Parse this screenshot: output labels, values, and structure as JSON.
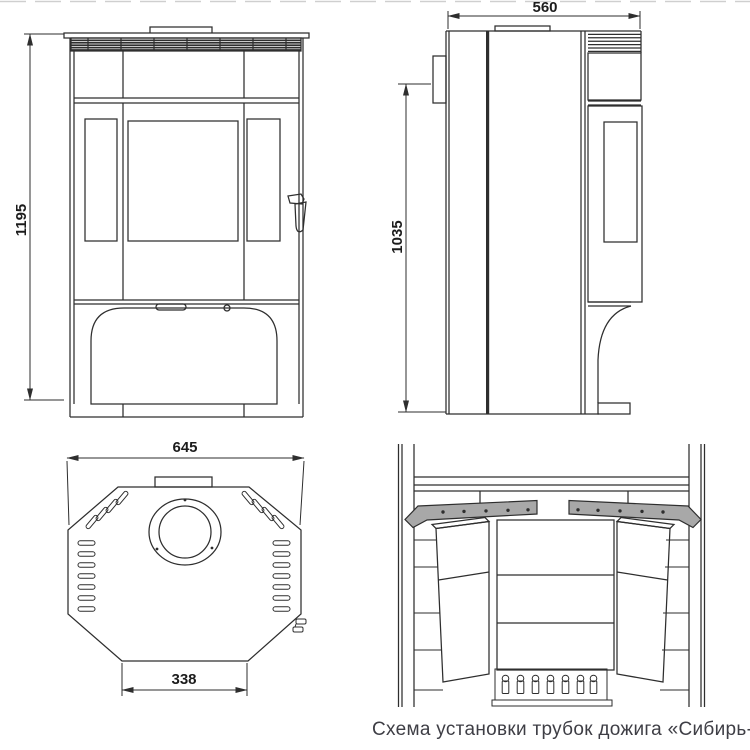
{
  "caption": "Схема установки трубок дожига «Сибирь-12'",
  "dimensions": {
    "front_height": "1195",
    "side_depth": "560",
    "side_flue_height": "1035",
    "top_width": "645",
    "top_base_width": "338"
  },
  "colors": {
    "line": "#2e2e2e",
    "dim_text": "#1c1c1c",
    "tube_fill": "#a8a8a8",
    "caption_text": "#3e3e45",
    "bg": "#ffffff"
  }
}
